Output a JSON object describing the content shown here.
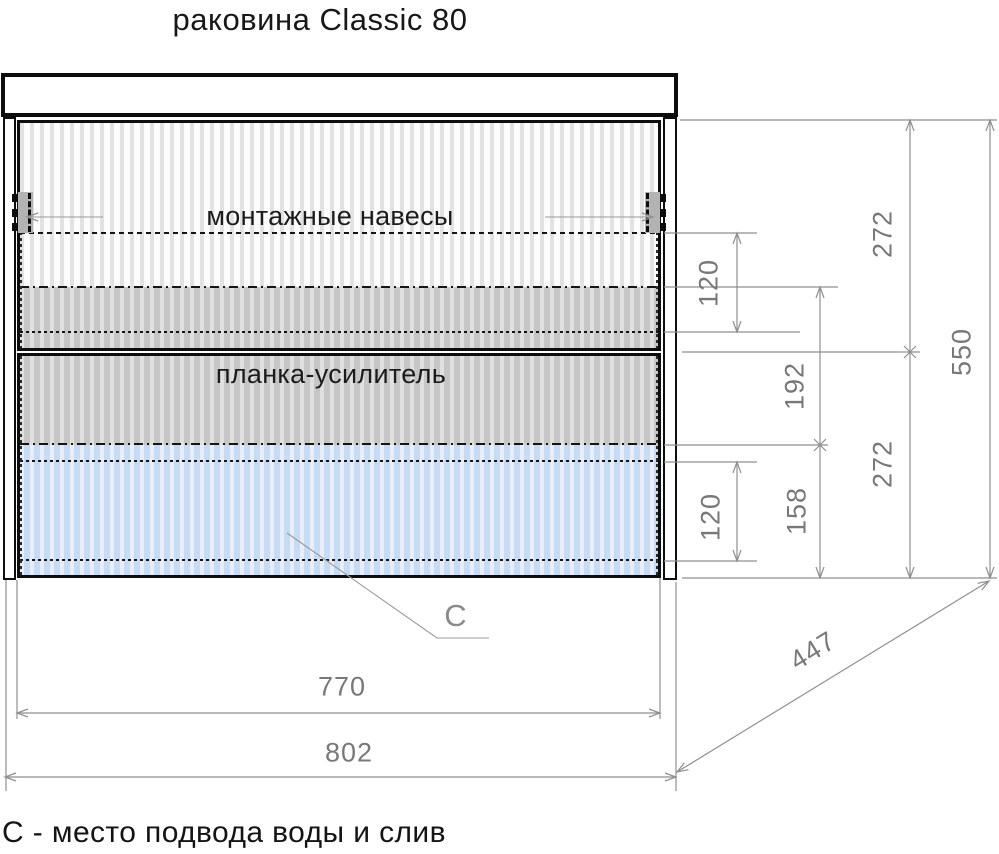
{
  "page": {
    "title": "раковина Classic 80",
    "footnote": "С - место подвода воды и слив"
  },
  "diagram": {
    "labels": {
      "mounting_hangers": "монтажные навесы",
      "reinforcement_strip": "планка-усилитель",
      "connection_marker": "С"
    },
    "dimensions": {
      "top_section_height": "272",
      "bottom_section_height": "272",
      "total_height": "550",
      "hanger_zone_height": "120",
      "strip_zone_height": "192",
      "drain_zone_height": "158",
      "drain_offset_height": "120",
      "depth_diagonal": "447",
      "drawer_width": "770",
      "total_width": "802"
    },
    "colors": {
      "structure_line": "#0d0d0d",
      "dimension_line": "#8f8f8f",
      "flute_white": "#fcfcfc",
      "flute_gray": "#c6c6c6",
      "flute_blue": "#c7dbf4"
    }
  }
}
